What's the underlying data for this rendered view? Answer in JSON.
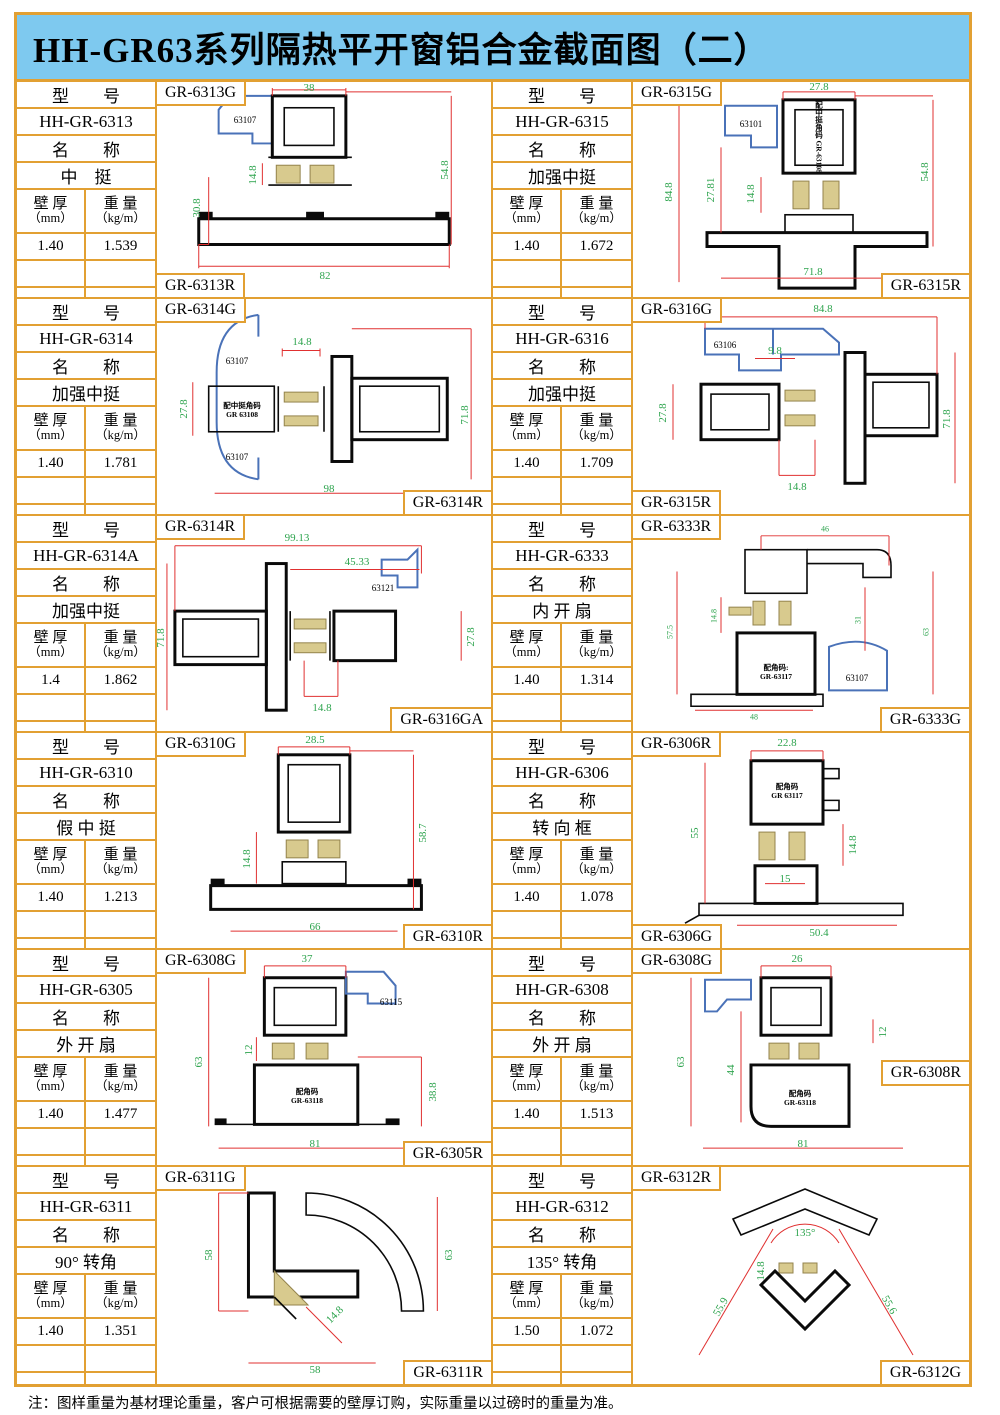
{
  "page": {
    "title": "HH-GR63系列隔热平开窗铝合金截面图（二）",
    "note": "注：图样重量为基材理论重量，客户可根据需要的壁厚订购，实际重量以过磅时的重量为准。"
  },
  "colors": {
    "frame_orange": "#E2A032",
    "title_blue": "#7EC9EF",
    "dim_green": "#2EA44E",
    "dim_red": "#E03030",
    "accent_blue": "#4A72B8",
    "thermal_tan": "#D8CA8E"
  },
  "table_labels": {
    "model": "型　　号",
    "name": "名　　称",
    "thickness_l1": "壁 厚",
    "thickness_l2": "（mm）",
    "weight_l1": "重 量",
    "weight_l2": "（kg/m）"
  },
  "cells": [
    {
      "model": "HH-GR-6313",
      "name": "中　挺",
      "thickness": "1.40",
      "weight": "1.539",
      "label_top": "GR-6313G",
      "label_bottom": "GR-6313R",
      "parts": [
        "63107"
      ],
      "dims": [
        "38",
        "30.8",
        "14.8",
        "54.8",
        "82"
      ]
    },
    {
      "model": "HH-GR-6315",
      "name": "加强中挺",
      "thickness": "1.40",
      "weight": "1.672",
      "label_top": "GR-6315G",
      "label_bottom": "GR-6315R",
      "parts": [
        "63101"
      ],
      "note": "配中挺角码 GR-63108",
      "dims": [
        "27.8",
        "84.8",
        "27.81",
        "14.8",
        "54.8",
        "71.8"
      ]
    },
    {
      "model": "HH-GR-6314",
      "name": "加强中挺",
      "thickness": "1.40",
      "weight": "1.781",
      "label_top": "GR-6314G",
      "label_bottom": "GR-6314R",
      "parts": [
        "63107",
        "63107"
      ],
      "note": "配中挺角码\nGR 63108",
      "dims": [
        "14.8",
        "27.8",
        "71.8",
        "98"
      ]
    },
    {
      "model": "HH-GR-6316",
      "name": "加强中挺",
      "thickness": "1.40",
      "weight": "1.709",
      "label_top": "GR-6316G",
      "label_bottom": "GR-6315R",
      "parts": [
        "63106"
      ],
      "dims": [
        "84.8",
        "9.8",
        "27.8",
        "71.8",
        "14.8"
      ]
    },
    {
      "model": "HH-GR-6314A",
      "name": "加强中挺",
      "thickness": "1.4",
      "weight": "1.862",
      "label_top": "GR-6314R",
      "label_bottom": "GR-6316GA",
      "parts": [
        "63121"
      ],
      "dims": [
        "99.13",
        "45.33",
        "71.8",
        "27.8",
        "14.8"
      ]
    },
    {
      "model": "HH-GR-6333",
      "name": "内 开 扇",
      "thickness": "1.40",
      "weight": "1.314",
      "label_top": "GR-6333R",
      "label_bottom": "GR-6333G",
      "parts": [
        "63107"
      ],
      "note": "配角码:\nGR-63117",
      "dims": [
        "46",
        "57.5",
        "14.8",
        "31",
        "63",
        "48"
      ]
    },
    {
      "model": "HH-GR-6310",
      "name": "假 中 挺",
      "thickness": "1.40",
      "weight": "1.213",
      "label_top": "GR-6310G",
      "label_bottom": "GR-6310R",
      "parts": [],
      "dims": [
        "28.5",
        "14.8",
        "58.7",
        "66"
      ]
    },
    {
      "model": "HH-GR-6306",
      "name": "转 向 框",
      "thickness": "1.40",
      "weight": "1.078",
      "label_top": "GR-6306R",
      "label_bottom": "GR-6306G",
      "parts": [],
      "note": "配角码\nGR 63117",
      "dims": [
        "22.8",
        "55",
        "14.8",
        "15",
        "50.4"
      ]
    },
    {
      "model": "HH-GR-6305",
      "name": "外 开 扇",
      "thickness": "1.40",
      "weight": "1.477",
      "label_top": "GR-6308G",
      "label_bottom": "GR-6305R",
      "parts": [
        "63115"
      ],
      "note": "配角码\nGR-63118",
      "dims": [
        "37",
        "63",
        "12",
        "38.8",
        "81"
      ]
    },
    {
      "model": "HH-GR-6308",
      "name": "外 开 扇",
      "thickness": "1.40",
      "weight": "1.513",
      "label_top": "GR-6308G",
      "label_bottom": "GR-6308R",
      "parts": [],
      "note": "配角码\nGR-63118",
      "dims": [
        "26",
        "63",
        "44",
        "12",
        "81"
      ]
    },
    {
      "model": "HH-GR-6311",
      "name": "90° 转角",
      "thickness": "1.40",
      "weight": "1.351",
      "label_top": "GR-6311G",
      "label_bottom": "GR-6311R",
      "parts": [],
      "dims": [
        "58",
        "63",
        "14.8",
        "58"
      ]
    },
    {
      "model": "HH-GR-6312",
      "name": "135° 转角",
      "thickness": "1.50",
      "weight": "1.072",
      "label_top": "GR-6312R",
      "label_bottom": "GR-6312G",
      "parts": [],
      "dims": [
        "135°",
        "14.8",
        "55.9",
        "55.6"
      ]
    }
  ]
}
